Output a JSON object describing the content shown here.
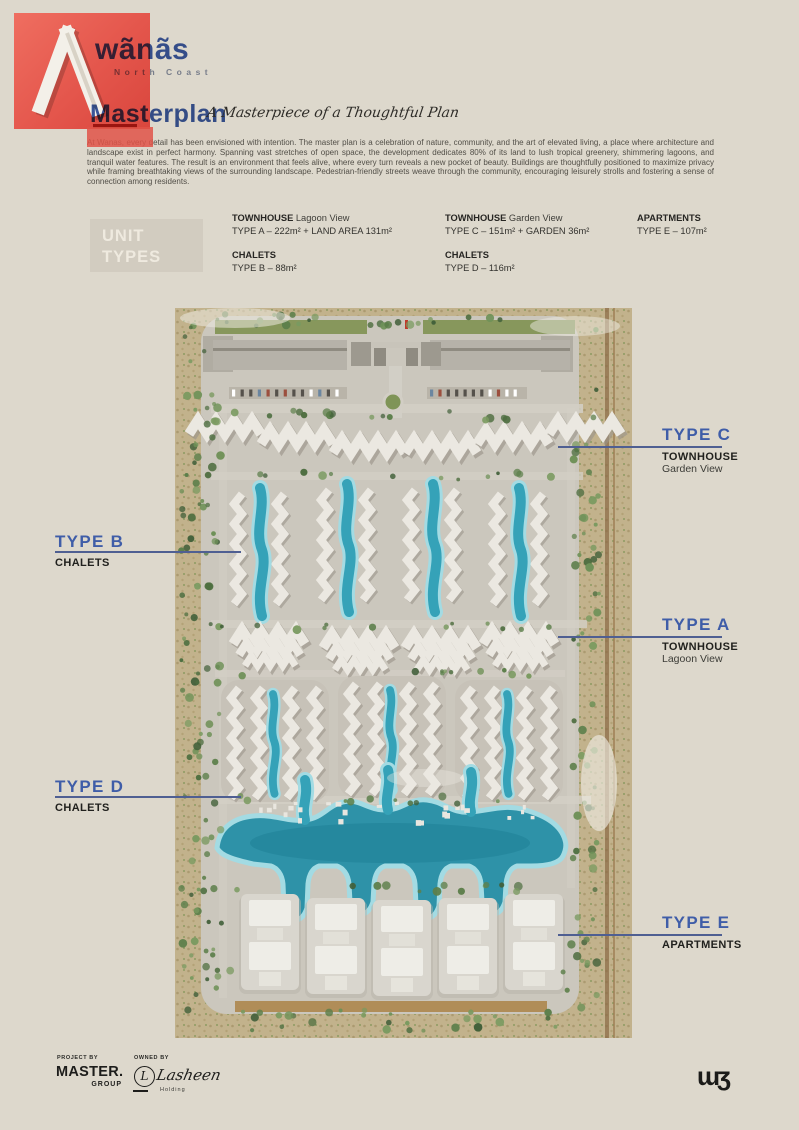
{
  "brand": {
    "name": "wãnãs",
    "tagline": "North Coast",
    "monogram": "ɯʒ"
  },
  "header": {
    "title": "Masterplan",
    "subtitle": "A Masterpiece of a Thoughtful Plan",
    "paragraph": "At Wanas, every detail has been envisioned with intention. The master plan is a celebration of nature, community, and the art of elevated living, a place where architecture and landscape exist in perfect harmony. Spanning vast stretches of open space, the development dedicates 80% of its land to lush tropical greenery, shimmering lagoons, and tranquil water features. The result is an environment that feels alive, where every turn reveals a new pocket of beauty. Buildings are thoughtfully positioned to maximize privacy while framing breathtaking views of the surrounding landscape. Pedestrian-friendly streets weave through the community, encouraging leisurely strolls and fostering a sense of connection among residents."
  },
  "unit_types": {
    "box_line1": "UNIT",
    "box_line2": "TYPES",
    "groups": [
      {
        "category": "TOWNHOUSE",
        "variant": "Lagoon View",
        "spec": "TYPE A – 222m² + LAND AREA 131m²"
      },
      {
        "category": "CHALETS",
        "variant": "",
        "spec": "TYPE B – 88m²"
      },
      {
        "category": "TOWNHOUSE",
        "variant": "Garden View",
        "spec": "TYPE C – 151m² + GARDEN 36m²"
      },
      {
        "category": "CHALETS",
        "variant": "",
        "spec": "TYPE D – 116m²"
      },
      {
        "category": "APARTMENTS",
        "variant": "",
        "spec": "TYPE E – 107m²"
      }
    ]
  },
  "map_labels": [
    {
      "type": "TYPE C",
      "category": "TOWNHOUSE",
      "variant": "Garden View"
    },
    {
      "type": "TYPE B",
      "category": "CHALETS",
      "variant": ""
    },
    {
      "type": "TYPE A",
      "category": "TOWNHOUSE",
      "variant": "Lagoon View"
    },
    {
      "type": "TYPE D",
      "category": "CHALETS",
      "variant": ""
    },
    {
      "type": "TYPE E",
      "category": "APARTMENTS",
      "variant": ""
    }
  ],
  "footer": {
    "project_by_label": "PROJECT BY",
    "project_name": "MASTER.",
    "project_sub": "GROUP",
    "owned_by_label": "OWNED BY",
    "owner_name": "Lasheen",
    "owner_sub": "Holding"
  },
  "colors": {
    "page_bg": "#ddd8cc",
    "accent_red": "#e4564c",
    "brand_blue": "#3f5da8",
    "lagoon": "#35a2b8"
  }
}
